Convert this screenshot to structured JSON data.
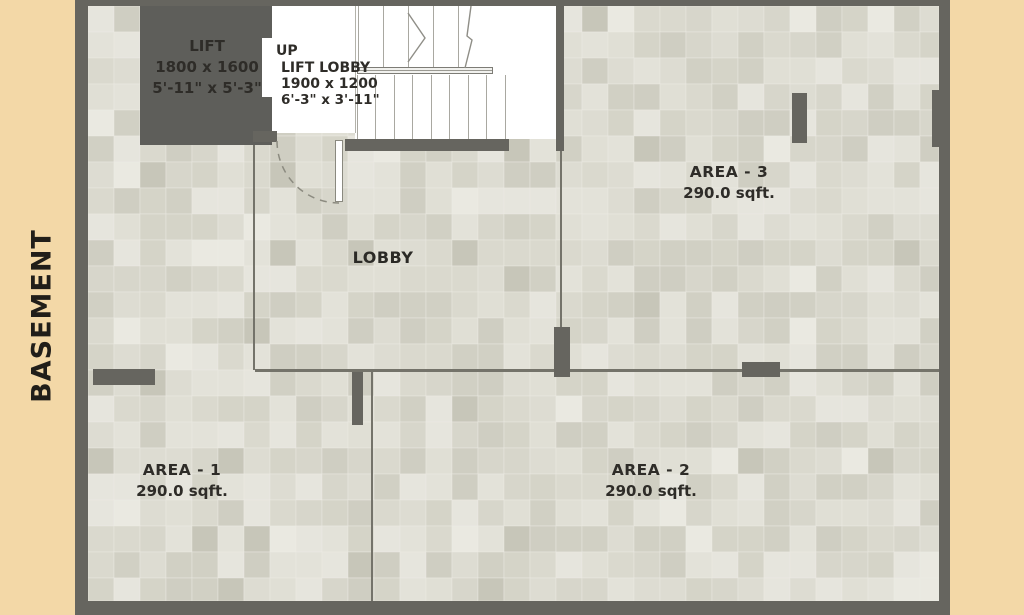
{
  "title": "BASEMENT",
  "rooms": {
    "lift": {
      "name": "LIFT",
      "dim_mm": "1800 x 1600",
      "dim_ft": "5'-11\" x 5'-3\""
    },
    "lift_lobby": {
      "direction": "UP",
      "name": "LIFT LOBBY",
      "dim_mm": "1900 x 1200",
      "dim_ft": "6'-3\" x 3'-11\""
    },
    "lobby": {
      "name": "LOBBY"
    },
    "area1": {
      "name": "AREA - 1",
      "area": "290.0 sqft."
    },
    "area2": {
      "name": "AREA - 2",
      "area": "290.0 sqft."
    },
    "area3": {
      "name": "AREA - 3",
      "area": "290.0 sqft."
    }
  },
  "colors": {
    "background": "#f3d8a7",
    "wall": "#66655f",
    "floor_tile": "#dcdbd2",
    "room_fill": "#ffffff",
    "text": "#2e2c28"
  }
}
